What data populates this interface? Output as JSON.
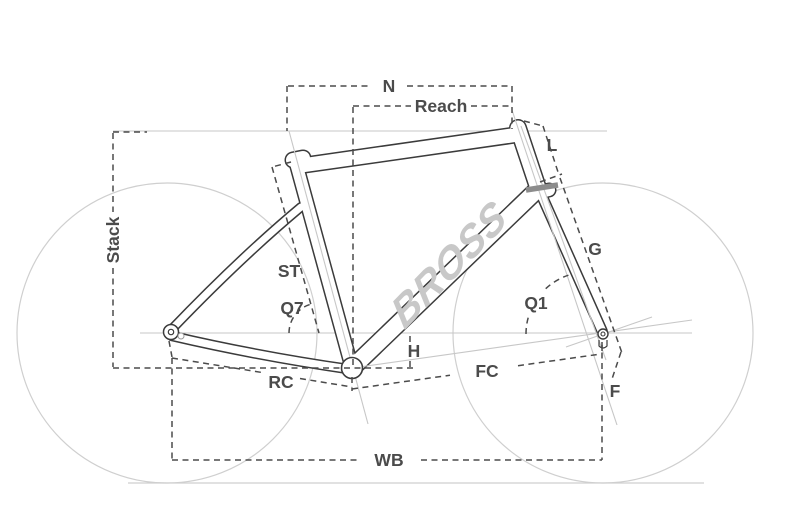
{
  "diagram": {
    "brand_logo": "BROSS",
    "labels": {
      "stack": "Stack",
      "n": "N",
      "reach": "Reach",
      "st": "ST",
      "q7": "Q7",
      "h": "H",
      "rc": "RC",
      "fc": "FC",
      "wb": "WB",
      "l": "L",
      "g": "G",
      "q1": "Q1",
      "f": "F"
    },
    "colors": {
      "background": "#ffffff",
      "frame_outline": "#3b3b3b",
      "frame_fill": "#ffffff",
      "construction_line": "#c7c7c7",
      "wheel_line": "#cfcfcf",
      "dimension_line": "#4b4b4b",
      "label_text": "#4b4b4b",
      "logo": "#c8c8c8",
      "fork_crown_band": "#8c8c8c"
    }
  }
}
